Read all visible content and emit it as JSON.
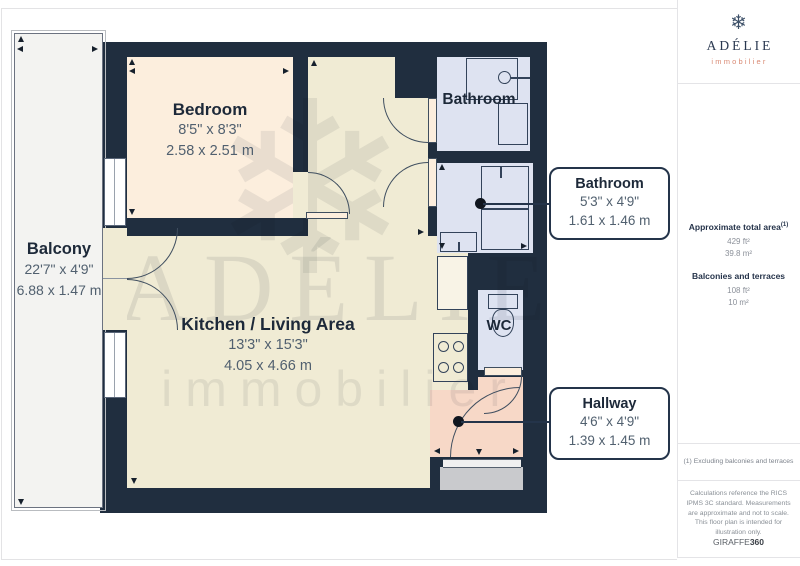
{
  "sidebar": {
    "logo": {
      "icon_glyph": "❄",
      "name": "ADÉLIE",
      "subtitle": "immobilier"
    },
    "area_summary": {
      "total_label": "Approximate total area",
      "total_footnote_marker": "(1)",
      "total_ft": "429 ft²",
      "total_m": "39.8 m²",
      "balcony_label": "Balconies and terraces",
      "balcony_ft": "108 ft²",
      "balcony_m": "10 m²"
    },
    "footnote": "(1) Excluding balconies and terraces",
    "disclaimer": "Calculations reference the RICS IPMS 3C standard. Measurements are approximate and not to scale. This floor plan is intended for illustration only.",
    "brand": {
      "regular": "GIRAFFE",
      "bold": "360"
    }
  },
  "floorplan": {
    "watermark": {
      "icon_glyph": "❄",
      "line1": "ADÉLIE",
      "line2": "immobilier"
    },
    "rooms": {
      "bedroom": {
        "name": "Bedroom",
        "imperial": "8'5\" x 8'3\"",
        "metric": "2.58 x 2.51 m"
      },
      "kitchen": {
        "name": "Kitchen / Living Area",
        "imperial": "13'3\" x 15'3\"",
        "metric": "4.05 x 4.66 m"
      },
      "balcony": {
        "name": "Balcony",
        "imperial": "22'7\" x 4'9\"",
        "metric": "6.88 x 1.47 m"
      },
      "bathroom_top": {
        "name": "Bathroom"
      },
      "wc": {
        "name": "WC"
      }
    },
    "callouts": {
      "bathroom": {
        "name": "Bathroom",
        "imperial": "5'3\" x 4'9\"",
        "metric": "1.61 x 1.46 m"
      },
      "hallway": {
        "name": "Hallway",
        "imperial": "4'6\" x 4'9\"",
        "metric": "1.39 x 1.45 m"
      }
    },
    "colors": {
      "wall": "#202e3f",
      "bedroom": "#fceedd",
      "kitchen": "#f0ebd4",
      "bathroom": "#dee3f1",
      "hallway": "#f7d8c7",
      "balcony": "#f3f3f1",
      "landing": "#c9cacd",
      "callout_border": "#24344a",
      "dimension_text": "#51606f",
      "logo_accent": "#d98a74"
    }
  }
}
